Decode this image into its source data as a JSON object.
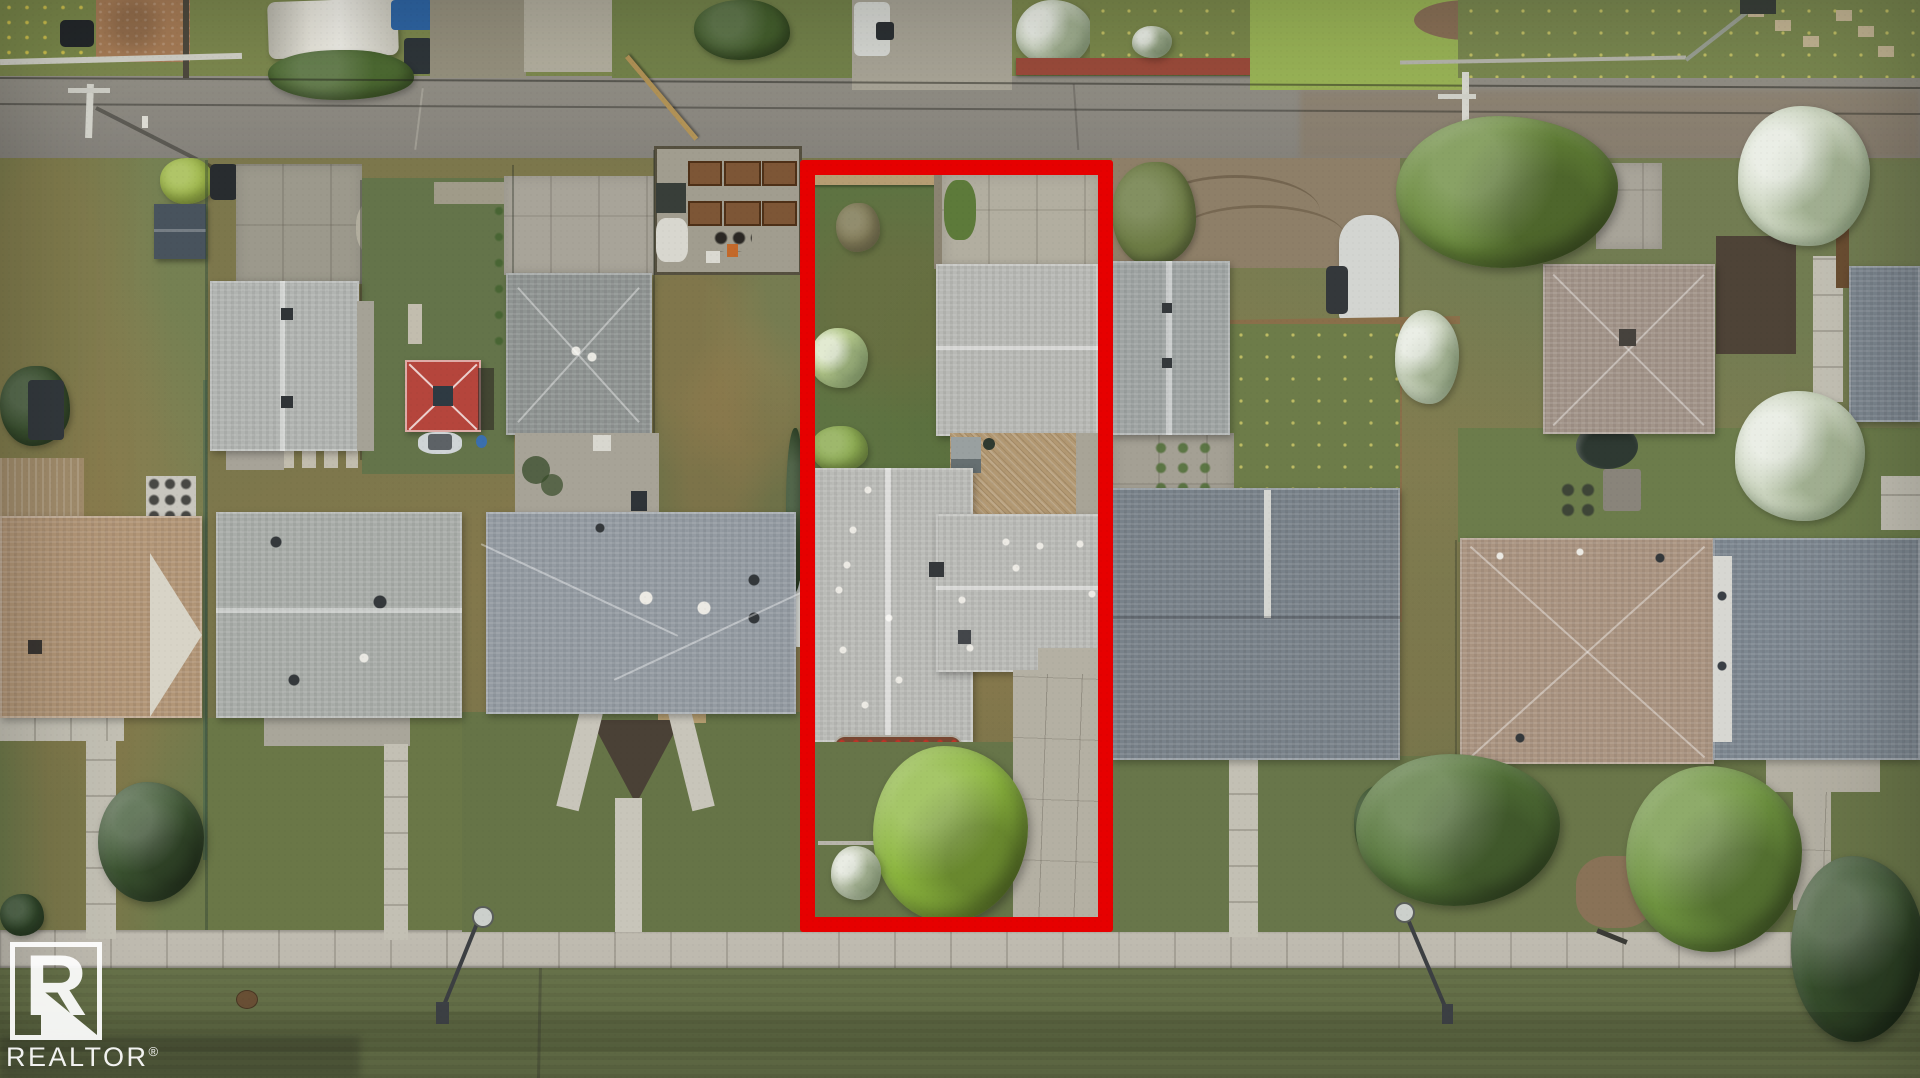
{
  "watermark": {
    "initial": "R",
    "brand": "REALTOR",
    "registered": "®"
  },
  "highlight": {
    "color": "#e60000",
    "shape": "rectangle"
  }
}
